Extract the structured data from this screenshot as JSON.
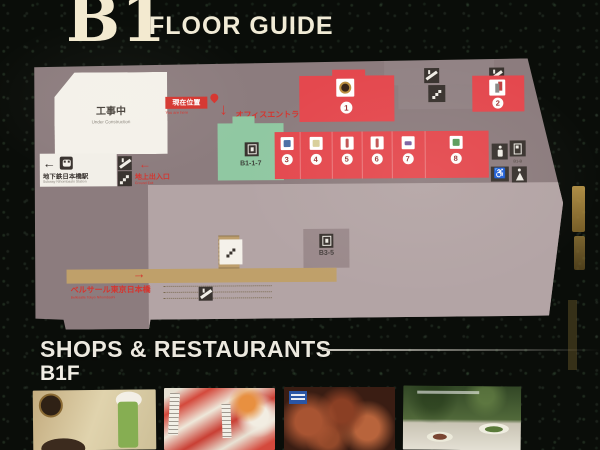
{
  "header": {
    "floor_code": "B1",
    "title": "FLOOR GUIDE"
  },
  "map": {
    "construction": {
      "jp": "工事中",
      "en": "Under Construction"
    },
    "current_location": {
      "jp": "現在位置",
      "en": "You are here"
    },
    "office_entrance": {
      "jp": "オフィスエントランス"
    },
    "ground_exit": {
      "jp": "地上出入口",
      "en": "Ground Exit"
    },
    "subway": {
      "jp": "地下鉄日本橋駅",
      "en": "Subway Nihombashi Station"
    },
    "bellesalle": {
      "jp": "ベルサール東京日本橋",
      "en": "Bellesalle Tokyo Nihombashi"
    },
    "office_unit_label": "B1-1-7",
    "elevator_label": "B3-5",
    "restroom_label": "B1-B",
    "units": [
      {
        "number": "1"
      },
      {
        "number": "2"
      },
      {
        "number": "3"
      },
      {
        "number": "4"
      },
      {
        "number": "5"
      },
      {
        "number": "6"
      },
      {
        "number": "7"
      },
      {
        "number": "8"
      }
    ]
  },
  "icons": {
    "left_arrow": "←",
    "down_arrow": "↓",
    "right_arrow": "→",
    "wheelchair": "♿"
  },
  "footer": {
    "heading": "SHOPS & RESTAURANTS",
    "floor_label": "B1F"
  },
  "colors": {
    "accent_red": "#e4484e",
    "signal_red": "#d5352f",
    "office_green": "#90c8a2",
    "corridor_tan": "#bfa06a"
  }
}
